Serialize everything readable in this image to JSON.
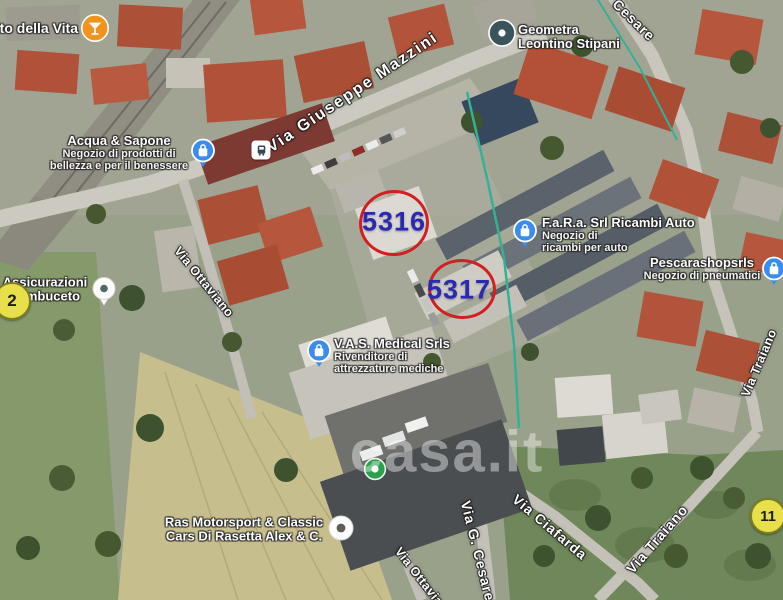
{
  "watermark": {
    "text": "casa.it"
  },
  "colors": {
    "parcel_ring": "#d02020",
    "parcel_number": "#2a2ab0",
    "pin_blue": "#3a8def",
    "pin_orange": "#f0931f",
    "pin_dark": "#3a545c",
    "marker_yellow": "#e7e04b",
    "watermark": "#ffffff"
  },
  "parcels": [
    {
      "number": "5316"
    },
    {
      "number": "5317"
    }
  ],
  "pois": [
    {
      "line1": "to della Vita",
      "icon": "cocktail-pin"
    },
    {
      "line1": "Geometra",
      "line2": "Leontino Stipani",
      "icon": "dot-pin"
    },
    {
      "line1": "Acqua & Sapone",
      "line2": "Negozio di prodotti di",
      "line3": "bellezza e per il benessere",
      "icon": "shopping-bag-pin"
    },
    {
      "line1": "F.a.R.a. Srl Ricambi Auto",
      "line2": "Negozio di",
      "line3": "ricambi per auto",
      "icon": "shopping-bag-pin"
    },
    {
      "line1": "Pescarashopsrls",
      "line2": "Negozio di pneumatici",
      "icon": "shopping-bag-pin"
    },
    {
      "line1": "Assicurazioni",
      "line2": "Sambuceto",
      "icon": "white-dot-pin"
    },
    {
      "line1": "V.A.S. Medical Srls",
      "line2": "Rivenditore di",
      "line3": "attrezzature mediche",
      "icon": "shopping-bag-pin"
    },
    {
      "line1": "Ras Motorsport & Classic",
      "line2": "Cars Di Rasetta Alex & C.",
      "icon": "white-dot-pin"
    }
  ],
  "streets": [
    {
      "label": "Via Giuseppe Mazzini"
    },
    {
      "label": "Cesare"
    },
    {
      "label": "Via Ottaviano"
    },
    {
      "label": "Via Ottaviano"
    },
    {
      "label": "Via G. Cesare"
    },
    {
      "label": "Via Ciafarda"
    },
    {
      "label": "Via Traiano"
    },
    {
      "label": "Via Traiano"
    }
  ],
  "markers": {
    "m2": {
      "label": "2"
    },
    "m11": {
      "label": "11"
    },
    "bus_stop": {
      "icon": "bus-icon"
    },
    "green_stop": {
      "icon": "green-dot-icon"
    }
  }
}
